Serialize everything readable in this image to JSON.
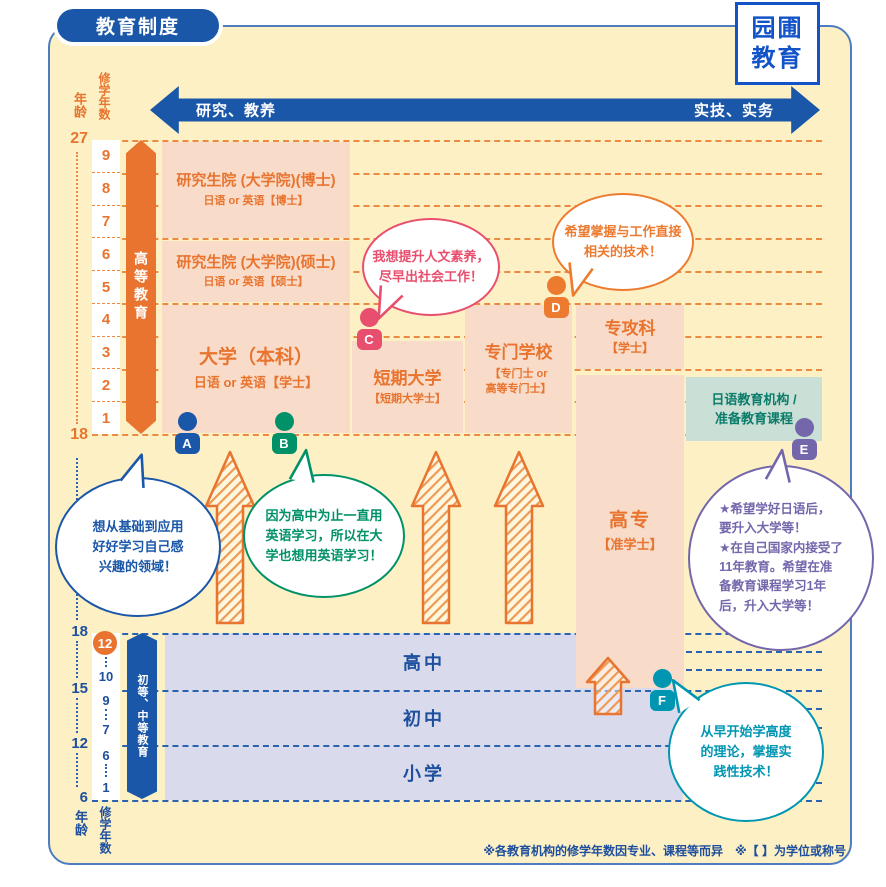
{
  "header": {
    "title": "教育制度"
  },
  "logo": {
    "line1": "园圃",
    "line2": "教育"
  },
  "orientation_arrow": {
    "left": "研究、教养",
    "right": "实技、实务"
  },
  "scale": {
    "top": {
      "age_label": "年龄",
      "years_label": "修学年数",
      "age_max": "27",
      "age_min": "18",
      "years": [
        "9",
        "8",
        "7",
        "6",
        "5",
        "4",
        "3",
        "2",
        "1"
      ]
    },
    "bottom": {
      "age_label": "年龄",
      "years_label": "修学年数",
      "ages": [
        "18",
        "15",
        "12",
        "6"
      ],
      "years": [
        "12",
        "10",
        "9",
        "7",
        "6",
        "1"
      ]
    }
  },
  "tracks": {
    "higher": "高等教育",
    "primary_secondary": "初等、中等教育"
  },
  "institutions": {
    "doctor": {
      "title": "研究生院 (大学院)(博士)",
      "subtitle": "日语 or 英语【博士】"
    },
    "master": {
      "title": "研究生院 (大学院)(硕士)",
      "subtitle": "日语 or 英语【硕士】"
    },
    "university": {
      "title": "大学（本科）",
      "subtitle": "日语 or 英语【学士】"
    },
    "junior_college": {
      "title": "短期大学",
      "subtitle": "【短期大学士】"
    },
    "vocational_school": {
      "title": "专门学校",
      "subtitle": "【专门士 or\n高等专门士】"
    },
    "advanced_course": {
      "title": "专攻科",
      "subtitle": "【学士】"
    },
    "kosen": {
      "title": "高专",
      "subtitle": "【准学士】"
    },
    "japanese_school": {
      "text": "日语教育机构 /\n准备教育课程"
    }
  },
  "schools": {
    "high": "高中",
    "junior_high": "初中",
    "elementary": "小学"
  },
  "students": {
    "A": {
      "label": "A",
      "color": "#1b57a8",
      "speech": "想从基础到应用\n好好学习自己感\n兴趣的领域！"
    },
    "B": {
      "label": "B",
      "color": "#009169",
      "speech": "因为高中为止一直用\n英语学习，所以在大\n学也想用英语学习！"
    },
    "C": {
      "label": "C",
      "color": "#e84e6d",
      "speech": "我想提升人文素养，\n尽早出社会工作！"
    },
    "D": {
      "label": "D",
      "color": "#ec7b30",
      "speech": "希望掌握与工作直接\n相关的技术！"
    },
    "E": {
      "label": "E",
      "color": "#7466ab",
      "speech": "★希望学好日语后，\n要升入大学等！\n★在自己国家内接受了\n11年教育。希望在准\n备教育课程学习1年\n后，升入大学等！"
    },
    "F": {
      "label": "F",
      "color": "#0096b2",
      "speech": "从早开始学高度\n的理论，掌握实\n践性技术！"
    }
  },
  "footnote": "※各教育机构的修学年数因专业、课程等而异　※【 】为学位或称号",
  "colors": {
    "accent_orange": "#e8742f",
    "accent_blue": "#1a57a8",
    "card_bg": "#fcf0c4",
    "box_pink": "#f8dcc9",
    "box_lavender": "#d9dbec",
    "box_teal": "#cadfd6",
    "teal_text": "#0b7c6a"
  }
}
